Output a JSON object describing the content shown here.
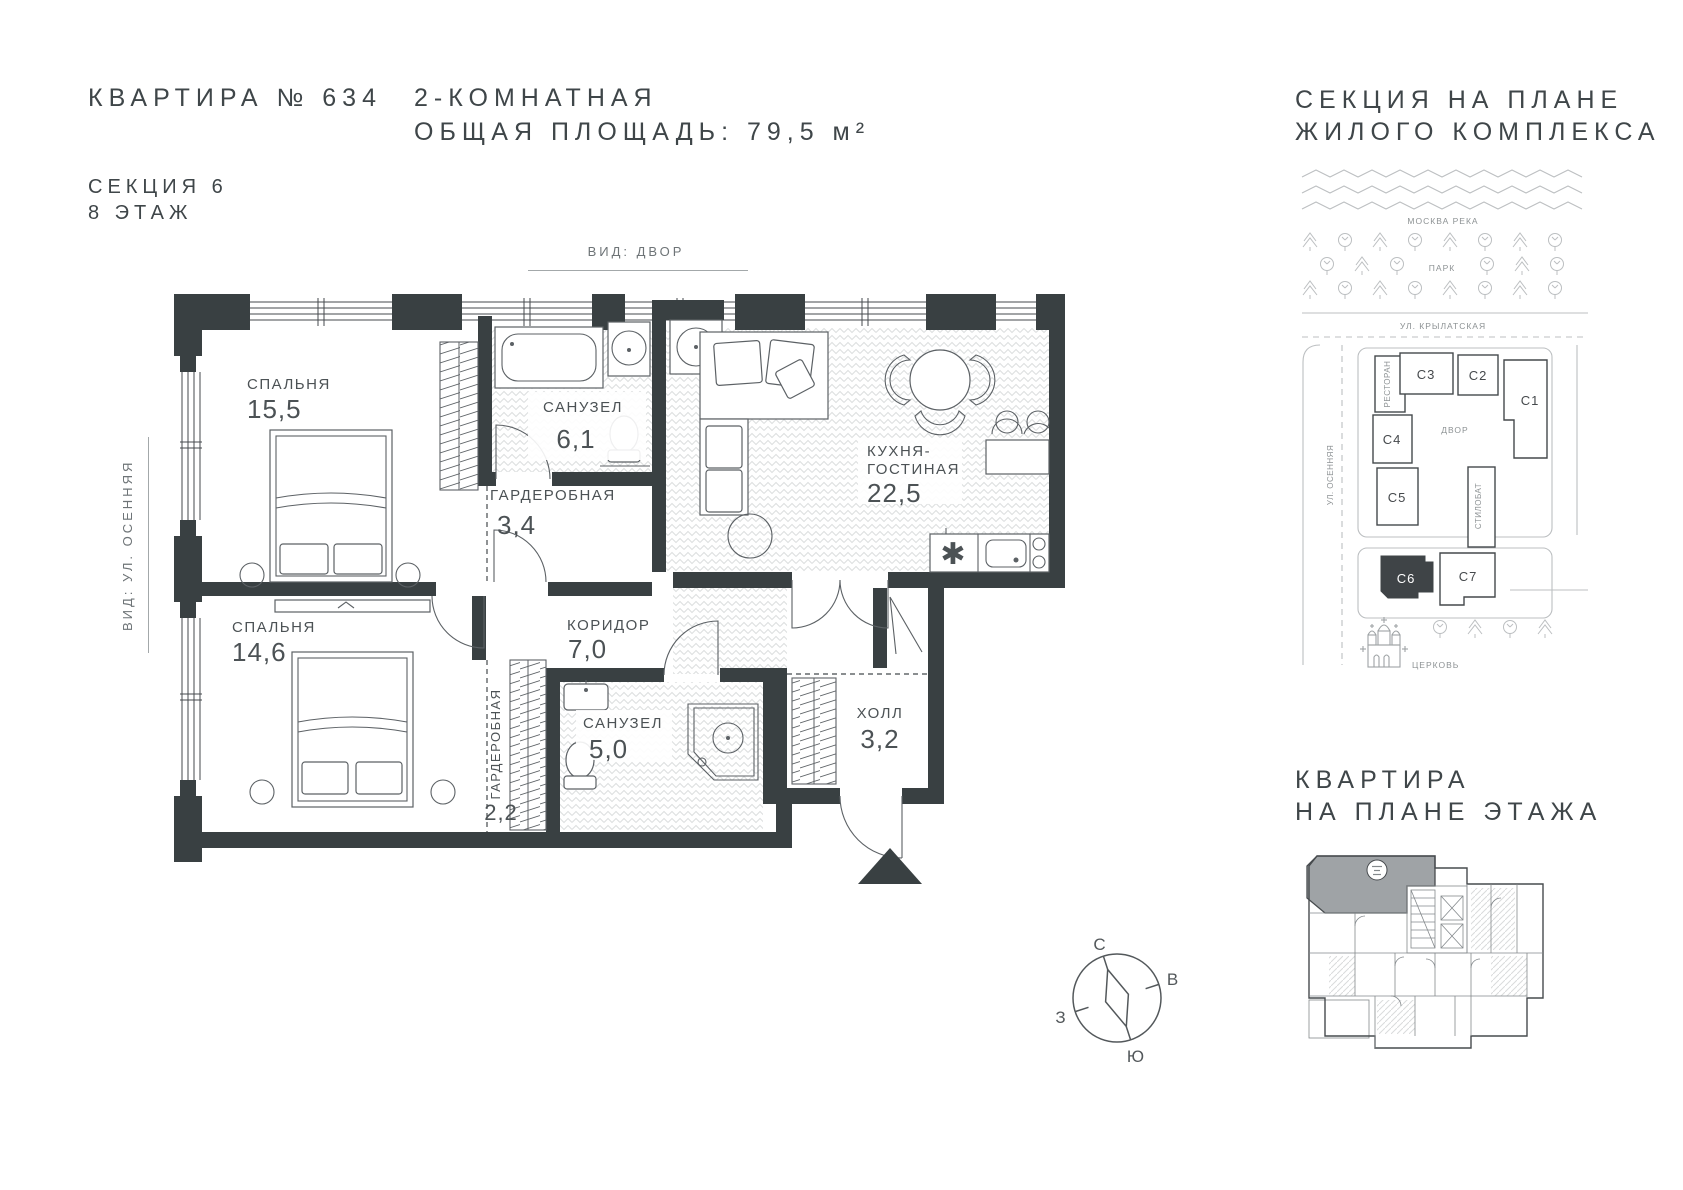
{
  "header": {
    "apartment_no": "КВАРТИРА № 634",
    "section": "СЕКЦИЯ 6",
    "floor": "8 ЭТАЖ",
    "apartment_type": "2-КОМНАТНАЯ",
    "total_area": "ОБЩАЯ ПЛОЩАДЬ: 79,5 м²"
  },
  "floor_plan": {
    "view_top": "ВИД: ДВОР",
    "view_left": "ВИД: УЛ. ОСЕННЯЯ",
    "rooms": [
      {
        "name": "СПАЛЬНЯ",
        "area": "15,5"
      },
      {
        "name": "САНУЗЕЛ",
        "area": "6,1"
      },
      {
        "name": "ГАРДЕРОБНАЯ",
        "area": "3,4"
      },
      {
        "name": "КУХНЯ-",
        "name2": "ГОСТИНАЯ",
        "area": "22,5"
      },
      {
        "name": "СПАЛЬНЯ",
        "area": "14,6"
      },
      {
        "name": "КОРИДОР",
        "area": "7,0"
      },
      {
        "name": "ГАРДЕРОБНАЯ",
        "area": "2,2"
      },
      {
        "name": "САНУЗЕЛ",
        "area": "5,0"
      },
      {
        "name": "ХОЛЛ",
        "area": "3,2"
      }
    ]
  },
  "site_plan": {
    "title_line1": "СЕКЦИЯ НА ПЛАНЕ",
    "title_line2": "ЖИЛОГО КОМПЛЕКСА",
    "river": "МОСКВА РЕКА",
    "park": "ПАРК",
    "street_top": "УЛ. КРЫЛАТСКАЯ",
    "street_left": "УЛ. ОСЕННЯЯ",
    "courtyard": "ДВОР",
    "restaurant": "РЕСТОРАН",
    "stylobate": "СТИЛОБАТ",
    "church": "ЦЕРКОВЬ",
    "buildings": [
      "С1",
      "С2",
      "С3",
      "С4",
      "С5",
      "С6",
      "С7"
    ],
    "highlighted_building": "С6"
  },
  "floor_map": {
    "title_line1": "КВАРТИРА",
    "title_line2": "НА ПЛАНЕ ЭТАЖА"
  },
  "compass": {
    "north": "С",
    "east": "В",
    "west": "З",
    "south": "Ю"
  },
  "colors": {
    "wall": "#394042",
    "text": "#3f4649",
    "muted": "#6e7477",
    "site_line": "#bcbfc1",
    "highlight": "#3f4447"
  }
}
